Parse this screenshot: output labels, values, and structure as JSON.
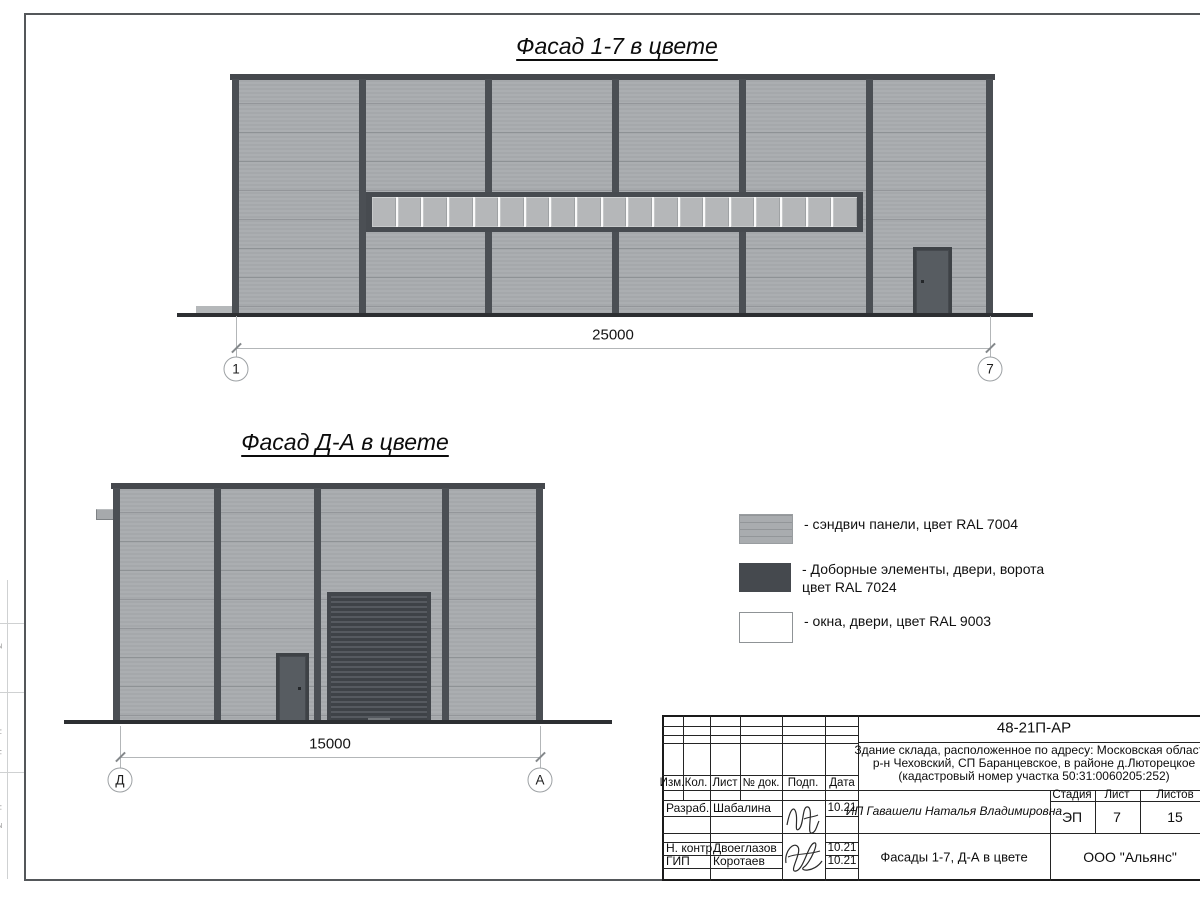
{
  "drawing": {
    "facade_top": {
      "title": "Фасад 1-7 в цвете",
      "dimension": "25000",
      "axis_left": "1",
      "axis_right": "7"
    },
    "facade_bottom": {
      "title": "Фасад Д-А в цвете",
      "dimension": "15000",
      "axis_left": "Д",
      "axis_right": "А"
    },
    "legend": [
      {
        "label": "- сэндвич панели, цвет RAL 7004"
      },
      {
        "label": "- Доборные элементы, двери, ворота",
        "label2": "цвет RAL 7024"
      },
      {
        "label": "- окна, двери, цвет RAL 9003"
      }
    ],
    "margin_labels": [
      "Взам. инв. №",
      "Подп. и дата",
      "Инв. № подл."
    ],
    "titleblock": {
      "code": "48-21П-АР",
      "address1": "Здание склада, расположенное по адресу: Московская область,",
      "address2": "р-н Чеховский, СП Баранцевское, в районе д.Люторецкое",
      "address3": "(кадастровый номер участка 50:31:0060205:252)",
      "col_izm": "Изм.",
      "col_kol": "Кол.",
      "col_list": "Лист",
      "col_ndok": "№ док.",
      "col_podp": "Подп.",
      "col_data": "Дата",
      "stage_label": "Стадия",
      "sheet_label": "Лист",
      "sheets_label": "Листов",
      "stage_value": "ЭП",
      "sheet_value": "7",
      "sheets_value": "15",
      "client": "ИП Гавашели Наталья Владимировна",
      "subject": "Фасады 1-7, Д-А в цвете",
      "company": "ООО \"Альянс\"",
      "row1_role": "Разраб.",
      "row1_name": "Шабалина",
      "row1_date": "10.21",
      "row2_role": "Н. контр.",
      "row2_name": "Двоеглазов",
      "row2_date": "10.21",
      "row3_role": "ГИП",
      "row3_name": "Коротаев",
      "row3_date": "10.21"
    },
    "colors": {
      "ral7004_panel": "#A8ABAE",
      "ral7024_dark": "#474B50",
      "ral9003_white": "#FFFFFF"
    }
  }
}
